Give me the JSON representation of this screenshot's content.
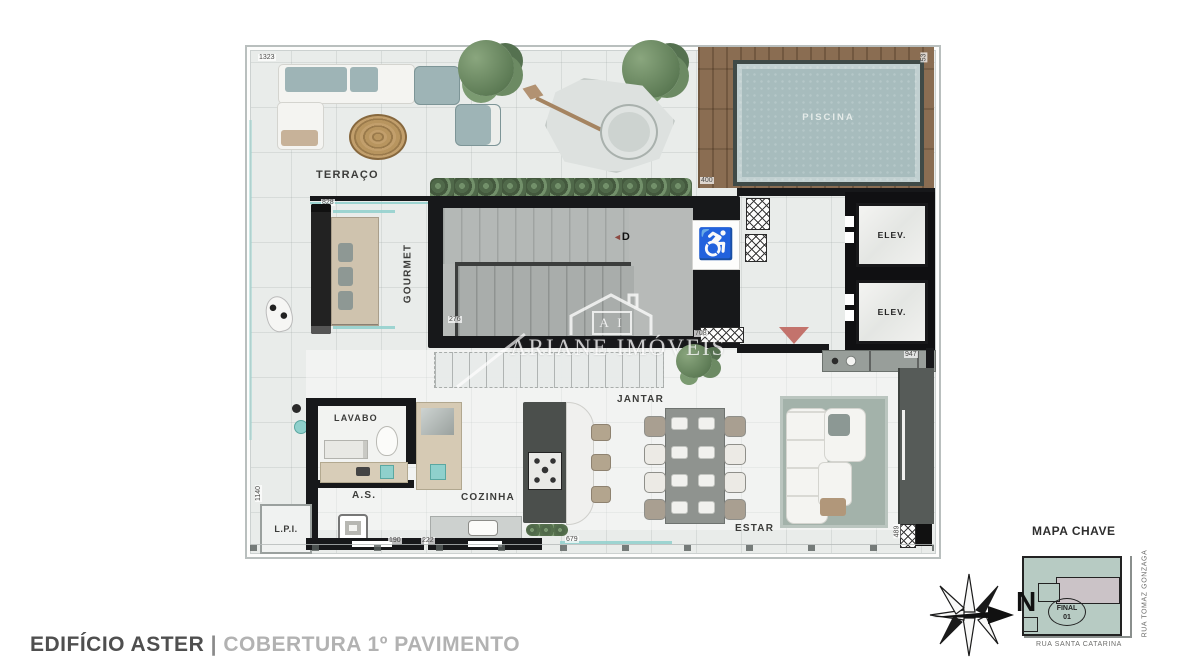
{
  "title": {
    "building": "EDIFÍCIO ASTER",
    "separator": "|",
    "floor": "COBERTURA 1º PAVIMENTO"
  },
  "plan": {
    "rooms": {
      "terraco": "TERRAÇO",
      "piscina": "PISCINA",
      "gourmet": "GOURMET",
      "elev": "ELEV.",
      "lavabo": "LAVABO",
      "servico": "A.S.",
      "lpi": "L.P.I.",
      "cozinha": "COZINHA",
      "jantar": "JANTAR",
      "estar": "ESTAR"
    },
    "stairs": {
      "arrow": "◄",
      "letter": "D"
    },
    "icons": {
      "wheelchair": "♿"
    },
    "dimensions": {
      "top_left": "1323",
      "top_right": "53",
      "pool_deck": "400",
      "gourmet": "828",
      "stairs_left": "276",
      "stairs_right": "708",
      "bar_counter": "947",
      "left_side": "1140",
      "as_left": "190",
      "as_right": "222",
      "cozinha_bottom": "679",
      "estar_right": "489"
    }
  },
  "watermark": {
    "initials": "A I",
    "name": "ARIANE IMÓVEIS"
  },
  "key_map": {
    "title": "MAPA CHAVE",
    "unit_line1": "FINAL",
    "unit_line2": "01",
    "street_bottom": "RUA SANTA CATARINA",
    "street_right": "RUA TOMAZ GONZAGA"
  },
  "compass": {
    "north": "N"
  },
  "colors": {
    "wall": "#17181a",
    "pool_water": "#a7bcbd",
    "deck_wood": "#8a6d52",
    "accent_teal": "#8fd0cc",
    "entry_marker": "#c3736c",
    "keymap_fill": "#b7cbc3",
    "title_dark": "#4f4f4f",
    "title_light": "#b2b2b2"
  }
}
